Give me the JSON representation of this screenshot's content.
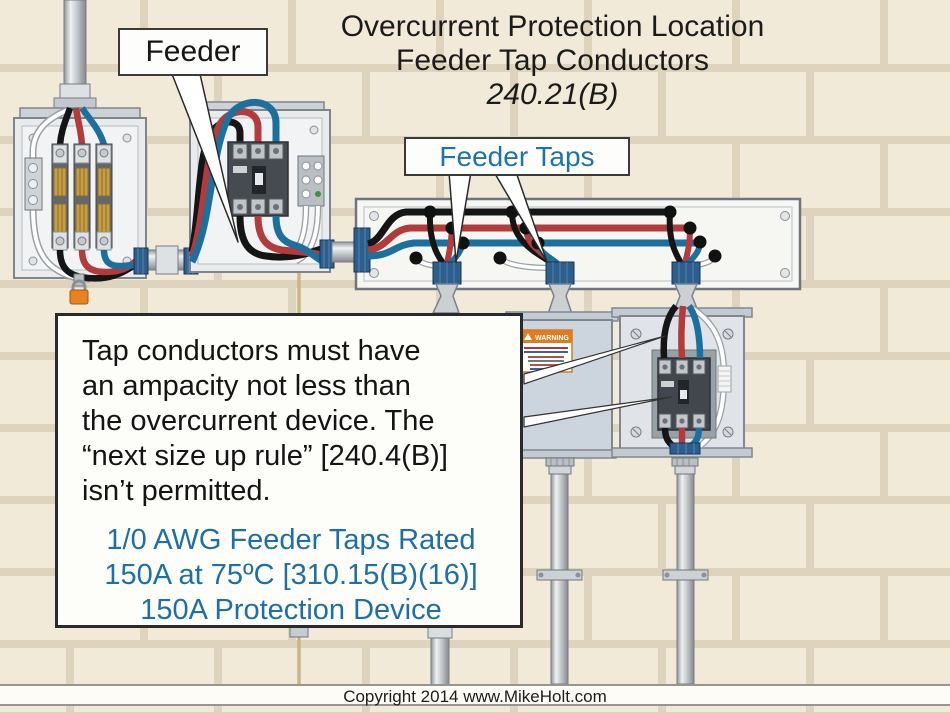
{
  "title": {
    "line1": "Overcurrent Protection Location",
    "line2": "Feeder Tap Conductors",
    "line3": "240.21(B)"
  },
  "callouts": {
    "feeder": "Feeder",
    "feeder_taps": "Feeder Taps"
  },
  "note": {
    "black_lines": [
      "Tap conductors must have",
      "an ampacity not less than",
      "the overcurrent device. The",
      "“next size up rule” [240.4(B)]",
      "isn’t permitted."
    ],
    "blue_lines": [
      "1/0 AWG Feeder Taps Rated",
      "150A at 75ºC [310.15(B)(16)]",
      "150A Protection Device"
    ]
  },
  "labels": {
    "warning": "WARNING"
  },
  "footer": {
    "copyright": "Copyright 2014 www.MikeHolt.com"
  },
  "colors": {
    "accent_blue_text": "#1d6fa5",
    "wire_black": "#151515",
    "wire_red": "#b23b3b",
    "wire_blue": "#1d6f9e",
    "wire_white": "#ffffff",
    "ground_tan": "#c9b585",
    "warning_orange": "#e07c1e",
    "brick": "#f2ead9",
    "mortar": "#ded4bd"
  }
}
